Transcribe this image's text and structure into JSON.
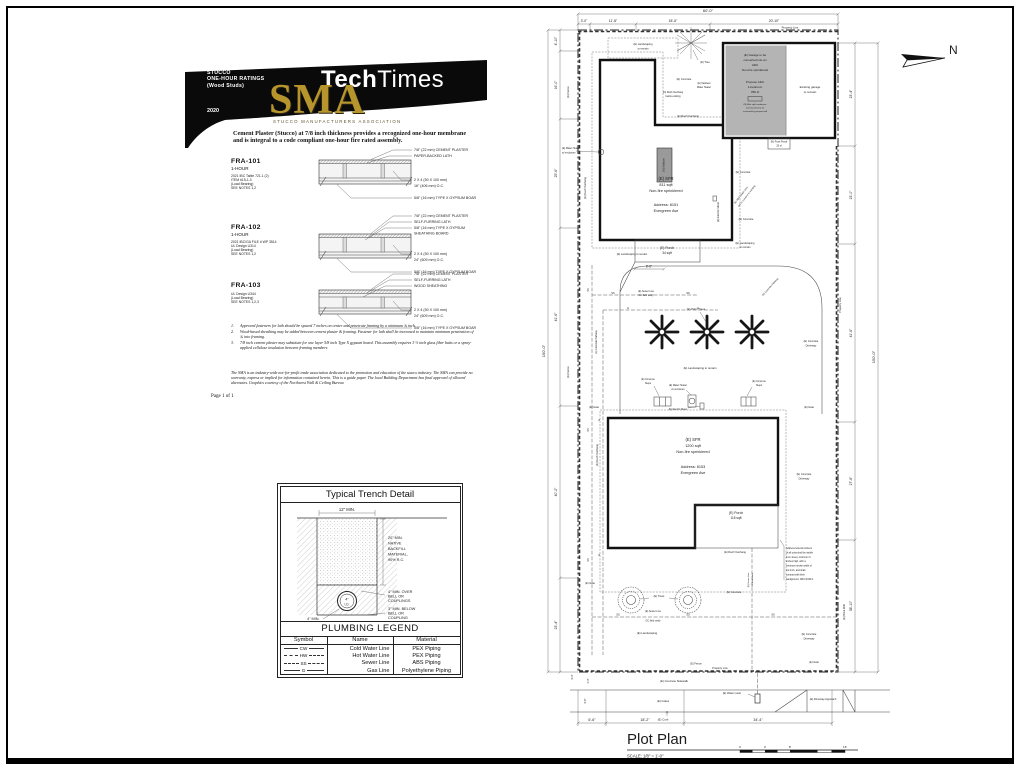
{
  "sma": {
    "banner": {
      "kicker1": "STUCCO",
      "kicker2": "ONE-HOUR RATINGS",
      "kicker3": "(Wood Studs)",
      "year": "2020",
      "logo": "SMA",
      "logo_subtitle": "STUCCO MANUFACTURERS ASSOCIATION",
      "masthead_bold": "Tech",
      "masthead_regular": "Times"
    },
    "intro_line1": "Cement Plaster (Stucco) at 7/8 inch thickness provides a recognized one-hour membrane",
    "intro_line2": "and is integral to a code compliant one-hour fire rated assembly.",
    "assemblies": [
      {
        "code": "FRA-101",
        "rating": "1-HOUR",
        "ref1": "2021  IBC Table 721.1 (2)",
        "ref2": "ITEM #15-1.3",
        "ref3": "(Load Bearing)",
        "ref4": "SEE NOTES 1,2",
        "t1": "7/8\" (22 mm) CEMENT PLASTER",
        "t2": "PAPER-BACKED LATH",
        "m1": "2 X 4 (50 X 100 mm)",
        "m2": "16\" (406 mm) O.C.",
        "b1": "5/8\" (16 mm) TYPE X GYPSUM BOARD"
      },
      {
        "code": "FRA-102",
        "rating": "1-HOUR",
        "ref1": "2021 IBC/GA FILE # WP 3514",
        "ref2": "UL Design U314",
        "ref3": "(Load Bearing)",
        "ref4": "SEE NOTES 1,2",
        "t1": "7/8\" (22 mm) CEMENT PLASTER",
        "t2": "SELF-FURRING LATH",
        "t3": "5/8\" (16 mm) TYPE X GYPSUM",
        "t4": "SHEATHING BOARD",
        "m1": "2 X 4 (50 X 100 mm)",
        "m2": "24\" (609 mm) O.C.",
        "b1": "5/8\" (16 mm) TYPE X GYPSUM BOARD"
      },
      {
        "code": "FRA-103",
        "rating": "",
        "ref1": "UL Design U344",
        "ref2": "(Load Bearing)",
        "ref3": "SEE NOTES 1,2,3",
        "ref4": "",
        "t1": "7/8\" (22 mm) CEMENT PLASTER",
        "t2": "SELF-FURRING LATH",
        "t3": "WOOD SHEATHING",
        "m1": "2 X 4 (50 X 100 mm)",
        "m2": "24\" (609 mm) O.C.",
        "b1": "5/8\" (16 mm) TYPE X GYPSUM BOARD"
      }
    ],
    "notes": [
      {
        "n": "1.",
        "t": "Approved fasteners for lath should be spaced 7 inches on center and penetrate framing by a minimum ¾ inch."
      },
      {
        "n": "2.",
        "t": "Wood-based sheathing may be added between cement plaster & framing.  Fastener for lath shall be increased to maintain minimum penetration of ¾ into framing."
      },
      {
        "n": "3.",
        "t": "7/8 inch cement plaster may substitute for one layer 5/8 inch Type X gypsum board. This assembly requires 3 ½ inch glass fiber batts or a spray-applied cellulose insulation between framing members"
      }
    ],
    "disclaimer": "The SMA is an  industry-wide not-for-profit trade association dedicated to the promotion and education of the stucco industry.  The SMA can provide no warranty, express or implied for information contained herein.  This is a guide paper.  The local Building Department has final approval of allowed alternates.  Graphics courtesy of the Northwest Wall & Ceiling Bureau",
    "page_label": "Page 1 of 1"
  },
  "trench": {
    "title": "Typical Trench Detail",
    "width_dim": "12\" MIN.",
    "backfill1": "20\" MIN.",
    "backfill2": "NATIVE",
    "backfill3": "BACKFILL",
    "backfill4": "MATERIAL,",
    "backfill5": "90% R.C.",
    "over1": "4\" MIN. OVER",
    "over2": "BELL OR",
    "over3": "COUPLINGS",
    "below1": "3\" MIN. BELOW",
    "below2": "BELL OR",
    "below3": "COUPLING",
    "bottom_dim": "4\" MIN.",
    "pipe_size": "4\"",
    "pipe_id": "I.D."
  },
  "legend": {
    "title": "PLUMBING LEGEND",
    "h1": "Symbol",
    "h2": "Name",
    "h3": "Material",
    "rows": [
      {
        "symbol": "CW",
        "name": "Cold Water Line",
        "material": "PEX Piping"
      },
      {
        "symbol": "HW",
        "name": "Hot Water Line",
        "material": "PEX Piping"
      },
      {
        "symbol": "SS",
        "name": "Sewer Line",
        "material": "ABS Piping"
      },
      {
        "symbol": "G",
        "name": "Gas Line",
        "material": "Polyethylene Piping"
      }
    ]
  },
  "plot": {
    "title": "Plot Plan",
    "scale": "SCALE: 1/8\" = 1'-0\"",
    "north": "N",
    "scale_ticks": [
      "0",
      "4'",
      "8'",
      "16'"
    ],
    "dims": {
      "top_overall": "60'-0\"",
      "top1": "3'-0\"",
      "top2": "11'-8\"",
      "top3": "18'-6\"",
      "top4": "20'-10\"",
      "left_overall": "150'-0\"",
      "left1": "4'-10\"",
      "left2": "16'-0\"",
      "left3": "25'-6\"",
      "left4": "41'-6\"",
      "left5": "40'-2\"",
      "left6": "23'-4\"",
      "right1": "23'-4\"",
      "right2": "23'-0\"",
      "right3": "41'-6\"",
      "right4": "27'-6\"",
      "right5": "38'-10\"",
      "right_overall": "150'-0\"",
      "bottom1": "6'-6\"",
      "bottom2": "18'-2\"",
      "bottom3": "34'-4\"",
      "porch_width": "8'-6\"",
      "strip1": "4'-0\"",
      "strip2": "5'-6\"",
      "strip3": "6'-0\""
    },
    "labels": {
      "property_line": "Property Line",
      "fence": "(E) Fence",
      "landscaping_1": "(E) Landscaping",
      "landscaping_2": "to remain",
      "landscaping_line": "(E) Landscaping to remain",
      "landscaping_only": "(E) Landscaping",
      "tree": "(E) Tree",
      "trees": "(E) Trees",
      "palm_trees": "(E) Palm Trees",
      "concrete": "(E) Concrete",
      "concrete_driveway_1": "(E) Concrete",
      "concrete_driveway_2": "Driveway",
      "concrete_pathway": "(E) Concrete Pathway",
      "concrete_steps_1": "(E) Concrete",
      "concrete_steps_2": "Steps",
      "concrete_sidewalk": "(E) Concrete Sidewalk",
      "grass": "(E) Grass",
      "curb": "(E) Curb",
      "gate": "(E) Gate",
      "water_heater_1": "(E) Water Heater",
      "water_heater_2": "w/ enclosure",
      "tankless_1": "(E) Tankless",
      "tankless_2": "Water Heater",
      "electric_meter": "(E) Electric Meter",
      "water_meter": "(E) Water meter",
      "driveway_approach": "(E) Driveway Approach",
      "brick_wall": "(E) Brick Wall",
      "roof_overhang": "(E) Roof Overhang",
      "new_overhang_1": "(N) Roof Overhang",
      "new_overhang_2": "below existing",
      "sewer_1": "(E) Sewer Line",
      "sewer_2": "GC field verify",
      "abs_sewer_1": "(E) ABS Sewer Line",
      "abs_sewer_2": "GC to connect to existing",
      "ss": "SS",
      "g": "G"
    },
    "house1": {
      "l1": "(E) SFR",
      "l2": "811 sqft",
      "l3": "Non-fire sprinklered",
      "l4": "Address: 8151",
      "l5": "Evergreen Ave"
    },
    "porch1": {
      "l1": "(E) Porch",
      "l2": "34 sqft"
    },
    "house2": {
      "l1": "(E) SFR",
      "l2": "1200 sqft",
      "l3": "Non-fire sprinklered",
      "l4": "Address: 8153",
      "l5": "Evergreen Ave"
    },
    "porch2": {
      "l1": "(E) Porch",
      "l2": "115 sqft"
    },
    "garage": {
      "a1": "(E) Garage to be",
      "a2": "converted into an",
      "a3": "ADU",
      "a4": "Non-fire sprinklered",
      "p1": "Propose ADU",
      "p2": "1-bedroom",
      "p3": "350 sf",
      "m1": "(N) Mini split condenser",
      "m2": "roof mounted to be",
      "m3": "screened by parapet wall",
      "e1": "Existing garage",
      "e2": "to remain"
    },
    "front_porch": {
      "l1": "(N) Front Porch",
      "l2": "25 sf"
    },
    "addition": "(N) Addition",
    "address_note": {
      "n1": "Address letters/numbers",
      "n2": "of all units shall be visible",
      "n3": "from street, minimum 3",
      "n4": "inches high, with a",
      "n5": "minimum stroke width of",
      "n6": "1/2 inch, and shall",
      "n7": "contrast with their",
      "n8": "background. CRC R319.1"
    }
  }
}
